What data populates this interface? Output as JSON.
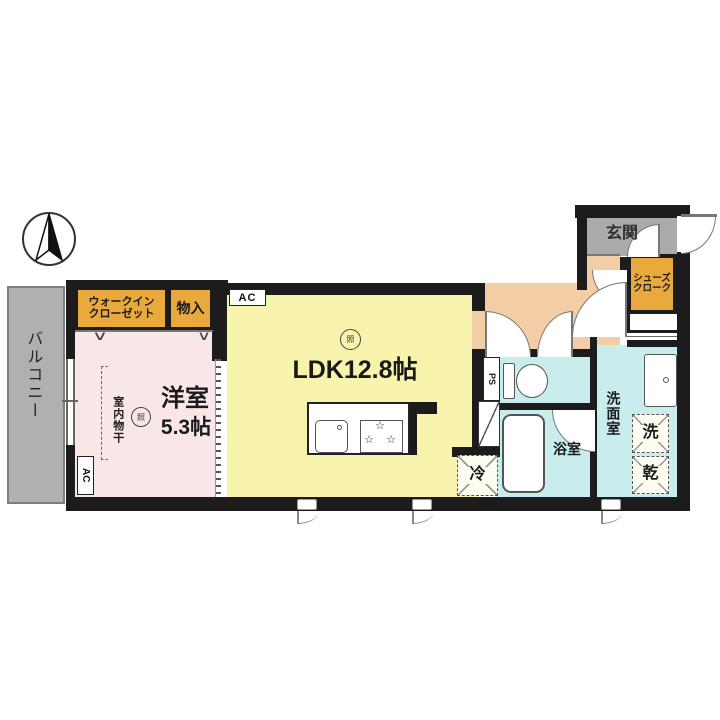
{
  "title": "apartment-floor-plan",
  "colors": {
    "wall": "#1c1c1c",
    "ldk": "#f8f4ae",
    "bedroom": "#f9e6e6",
    "hall": "#f3cda5",
    "closet": "#eaa93c",
    "entrance": "#ababab",
    "wet": "#c9eded",
    "balcony": "#b0b0b0"
  },
  "rooms": {
    "ldk": {
      "label": "LDK12.8帖"
    },
    "western": {
      "label": "洋室",
      "size": "5.3帖"
    },
    "balcony": {
      "label": "バルコニー"
    },
    "wic": {
      "line1": "ウォークイン",
      "line2": "クローゼット"
    },
    "storage": {
      "label": "物入"
    },
    "entrance": {
      "label": "玄関"
    },
    "shoe_cloak": {
      "line1": "シューズ",
      "line2": "クローク"
    },
    "bath": {
      "label": "浴室"
    },
    "washroom": {
      "label": "洗面室"
    }
  },
  "symbols": {
    "washer": "洗",
    "dryer": "乾",
    "fridge": "冷",
    "pipe_space": "PS",
    "air_con": "AC",
    "light": "照",
    "indoor_drying": "室内物干",
    "closet_door_mark": "∨",
    "burner_star": "☆"
  }
}
